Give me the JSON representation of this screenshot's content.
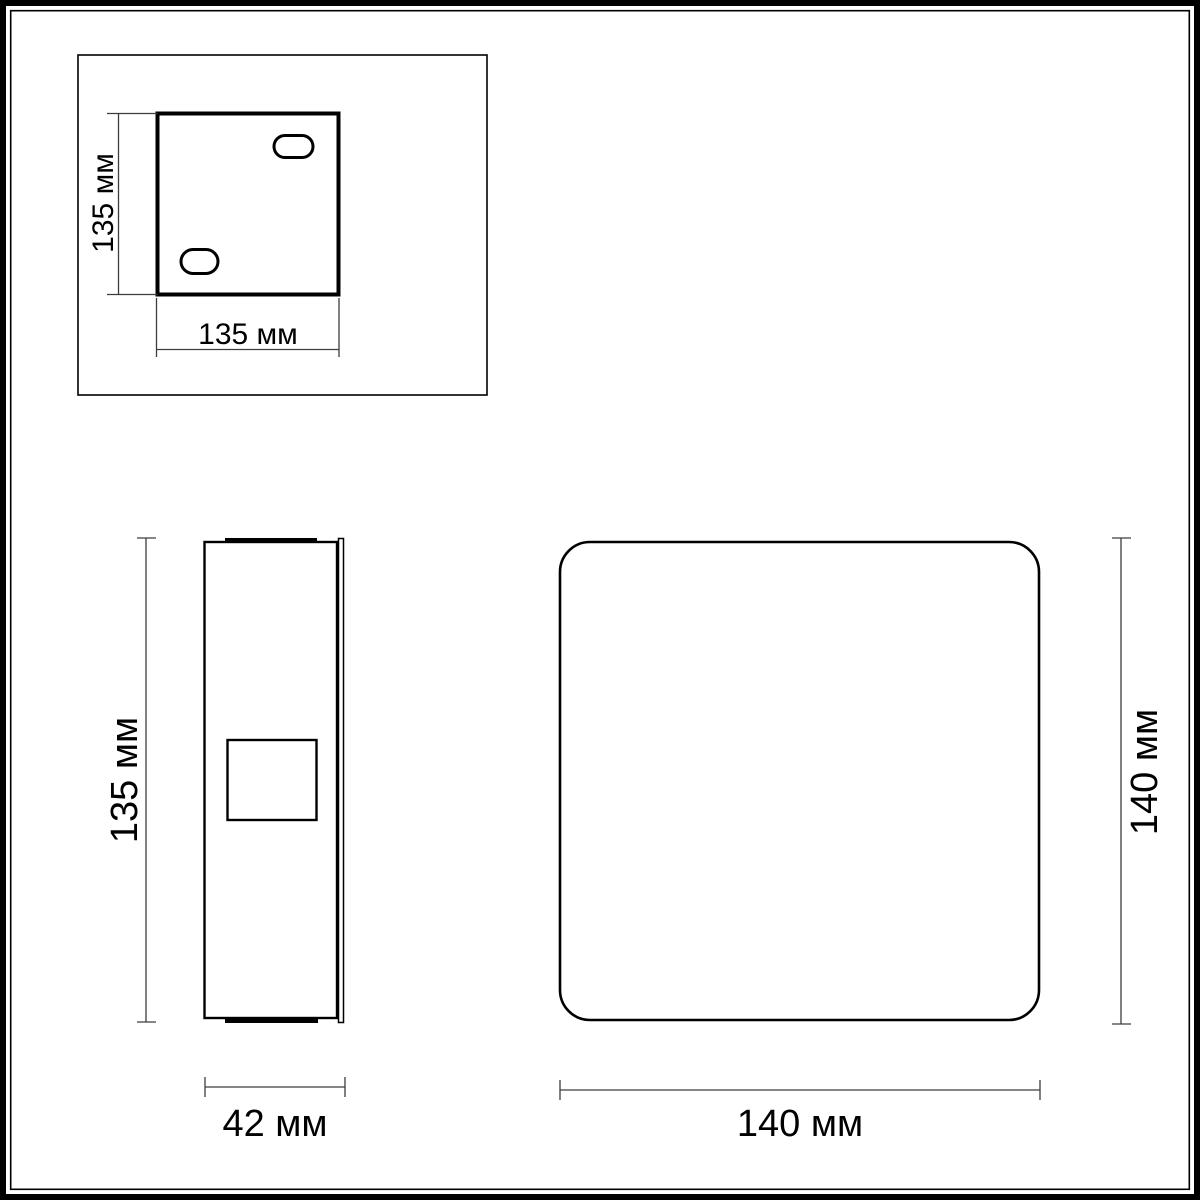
{
  "drawing": {
    "back_plate": {
      "height_label": "135 мм",
      "width_label": "135 мм"
    },
    "side_view": {
      "height_label": "135 мм",
      "depth_label": "42 мм"
    },
    "front_view": {
      "height_label": "140 мм",
      "width_label": "140 мм"
    },
    "colors": {
      "outline": "#000000",
      "dimension_line": "#3d3d3d",
      "background": "#ffffff"
    }
  }
}
